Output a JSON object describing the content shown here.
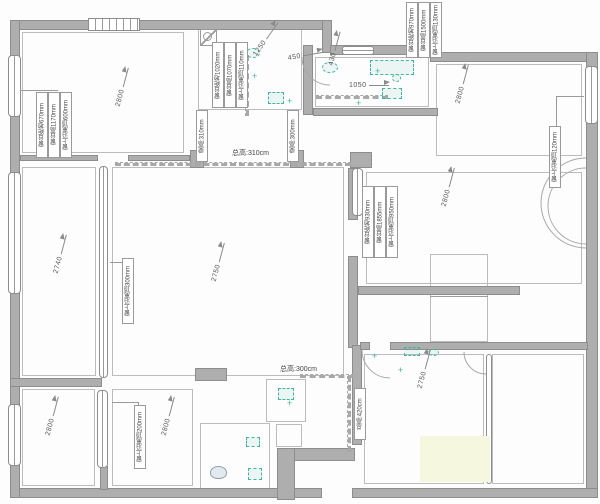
{
  "meta": {
    "app": "floor-plan-survey-drawing",
    "canvas": {
      "width": 600,
      "height": 504
    },
    "colors": {
      "wall": "#aeaeae",
      "wall_border": "#8d8d8d",
      "room_line": "#bcbcbc",
      "fixture_teal": "#45b3a2",
      "text": "#4a4a4a",
      "wash_yellow": "#f5f7df"
    }
  },
  "plan": {
    "walls": [
      {
        "x": 10,
        "y": 20,
        "w": 322,
        "h": 10
      },
      {
        "x": 322,
        "y": 20,
        "w": 10,
        "h": 33
      },
      {
        "x": 330,
        "y": 45,
        "w": 108,
        "h": 10
      },
      {
        "x": 430,
        "y": 52,
        "w": 158,
        "h": 10
      },
      {
        "x": 586,
        "y": 52,
        "w": 12,
        "h": 446
      },
      {
        "x": 352,
        "y": 488,
        "w": 246,
        "h": 10
      },
      {
        "x": 10,
        "y": 488,
        "w": 312,
        "h": 10
      },
      {
        "x": 10,
        "y": 20,
        "w": 10,
        "h": 478
      },
      {
        "x": 303,
        "y": 45,
        "w": 10,
        "h": 70
      },
      {
        "x": 313,
        "y": 108,
        "w": 125,
        "h": 8
      },
      {
        "x": 20,
        "y": 155,
        "w": 78,
        "h": 6
      },
      {
        "x": 128,
        "y": 155,
        "w": 62,
        "h": 6
      },
      {
        "x": 190,
        "y": 150,
        "w": 14,
        "h": 18
      },
      {
        "x": 290,
        "y": 150,
        "w": 14,
        "h": 18
      },
      {
        "x": 350,
        "y": 152,
        "w": 22,
        "h": 16
      },
      {
        "x": 348,
        "y": 168,
        "w": 10,
        "h": 52
      },
      {
        "x": 348,
        "y": 256,
        "w": 10,
        "h": 92
      },
      {
        "x": 358,
        "y": 286,
        "w": 162,
        "h": 9
      },
      {
        "x": 10,
        "y": 378,
        "w": 92,
        "h": 9
      },
      {
        "x": 195,
        "y": 368,
        "w": 32,
        "h": 13
      },
      {
        "x": 277,
        "y": 448,
        "w": 78,
        "h": 13
      },
      {
        "x": 277,
        "y": 448,
        "w": 18,
        "h": 52
      },
      {
        "x": 352,
        "y": 345,
        "w": 10,
        "h": 100
      },
      {
        "x": 360,
        "y": 342,
        "w": 10,
        "h": 8
      },
      {
        "x": 390,
        "y": 342,
        "w": 198,
        "h": 8
      },
      {
        "x": 100,
        "y": 466,
        "w": 8,
        "h": 24
      }
    ],
    "windows": [
      {
        "x": 8,
        "y": 55,
        "w": 13,
        "h": 62,
        "o": "v"
      },
      {
        "x": 8,
        "y": 172,
        "w": 13,
        "h": 122,
        "o": "v"
      },
      {
        "x": 8,
        "y": 404,
        "w": 13,
        "h": 62,
        "o": "v"
      },
      {
        "x": 88,
        "y": 18,
        "w": 52,
        "h": 13,
        "o": "hatch"
      },
      {
        "x": 342,
        "y": 46,
        "w": 32,
        "h": 9,
        "o": "h"
      },
      {
        "x": 585,
        "y": 66,
        "w": 13,
        "h": 58,
        "o": "v"
      },
      {
        "x": 352,
        "y": 168,
        "w": 11,
        "h": 48,
        "o": "v"
      },
      {
        "x": 99,
        "y": 166,
        "w": 9,
        "h": 212,
        "o": "v"
      },
      {
        "x": 97,
        "y": 390,
        "w": 11,
        "h": 78,
        "o": "v"
      },
      {
        "x": 486,
        "y": 354,
        "w": 6,
        "h": 130,
        "o": "v"
      }
    ],
    "rooms": [
      {
        "x": 22,
        "y": 32,
        "w": 162,
        "h": 121
      },
      {
        "x": 198,
        "y": 28,
        "w": 104,
        "h": 82
      },
      {
        "x": 315,
        "y": 57,
        "w": 114,
        "h": 50
      },
      {
        "x": 436,
        "y": 64,
        "w": 146,
        "h": 92
      },
      {
        "x": 22,
        "y": 167,
        "w": 74,
        "h": 209
      },
      {
        "x": 112,
        "y": 167,
        "w": 232,
        "h": 209
      },
      {
        "x": 366,
        "y": 172,
        "w": 216,
        "h": 112
      },
      {
        "x": 430,
        "y": 254,
        "w": 58,
        "h": 88
      },
      {
        "x": 22,
        "y": 389,
        "w": 73,
        "h": 97
      },
      {
        "x": 112,
        "y": 389,
        "w": 81,
        "h": 97
      },
      {
        "x": 200,
        "y": 423,
        "w": 70,
        "h": 68
      },
      {
        "x": 266,
        "y": 379,
        "w": 40,
        "h": 43
      },
      {
        "x": 276,
        "y": 424,
        "w": 26,
        "h": 23
      },
      {
        "x": 364,
        "y": 354,
        "w": 120,
        "h": 130
      },
      {
        "x": 492,
        "y": 354,
        "w": 92,
        "h": 130
      }
    ],
    "lines": [
      {
        "x": 20,
        "y": 90,
        "w": 38,
        "h": 0,
        "dash": 0
      },
      {
        "x": 556,
        "y": 96,
        "w": 28,
        "h": 0,
        "dash": 0
      },
      {
        "x": 556,
        "y": 96,
        "w": 0,
        "h": 30,
        "dash": 0
      },
      {
        "x": 110,
        "y": 262,
        "w": 14,
        "h": 0,
        "dash": 0
      },
      {
        "x": 112,
        "y": 402,
        "w": 26,
        "h": 0,
        "dash": 0
      },
      {
        "x": 138,
        "y": 402,
        "w": 0,
        "h": 6,
        "dash": 0
      },
      {
        "x": 115,
        "y": 162,
        "w": 230,
        "h": 0,
        "dash": 1
      },
      {
        "x": 300,
        "y": 374,
        "w": 48,
        "h": 0,
        "dash": 1
      },
      {
        "x": 347,
        "y": 376,
        "w": 0,
        "h": 70,
        "dash": 1
      },
      {
        "x": 430,
        "y": 296,
        "w": 58,
        "h": 0,
        "dash": 0
      },
      {
        "x": 316,
        "y": 95,
        "w": 66,
        "h": 0,
        "dash": 1
      },
      {
        "x": 245,
        "y": 55,
        "w": 0,
        "h": 55,
        "dash": 1
      }
    ],
    "arcs": [
      {
        "d": "M 302,57 A 28,28 0 0 0 330,85"
      },
      {
        "d": "M 362,350 A 28,28 0 0 0 390,378"
      },
      {
        "d": "M 464,352 A 22,22 0 0 0 486,374"
      },
      {
        "d": "M 586,158 A 45,45 0 0 0 586,248"
      },
      {
        "d": "M 586,168 A 38,38 0 0 0 586,244"
      }
    ],
    "fixtures": [
      {
        "t": "shower",
        "x": 200,
        "y": 29,
        "w": 17,
        "h": 17
      },
      {
        "t": "ell",
        "x": 246,
        "y": 48,
        "w": 14,
        "h": 10
      },
      {
        "t": "rect",
        "x": 268,
        "y": 92,
        "w": 16,
        "h": 12
      },
      {
        "t": "cross",
        "x": 252,
        "y": 72
      },
      {
        "t": "cross",
        "x": 287,
        "y": 97
      },
      {
        "t": "ell",
        "x": 322,
        "y": 62,
        "w": 16,
        "h": 11
      },
      {
        "t": "rect",
        "x": 370,
        "y": 60,
        "w": 44,
        "h": 15
      },
      {
        "t": "rect",
        "x": 382,
        "y": 88,
        "w": 20,
        "h": 11
      },
      {
        "t": "cross",
        "x": 356,
        "y": 99
      },
      {
        "t": "cross",
        "x": 375,
        "y": 67
      },
      {
        "t": "ell",
        "x": 392,
        "y": 74,
        "w": 9,
        "h": 8
      },
      {
        "t": "rect",
        "x": 404,
        "y": 347,
        "w": 16,
        "h": 9
      },
      {
        "t": "ell",
        "x": 428,
        "y": 349,
        "w": 11,
        "h": 7
      },
      {
        "t": "cross",
        "x": 372,
        "y": 352
      },
      {
        "t": "cross",
        "x": 398,
        "y": 366
      },
      {
        "t": "wash",
        "x": 420,
        "y": 436,
        "w": 70,
        "h": 46
      },
      {
        "t": "toilet",
        "x": 210,
        "y": 466,
        "w": 17,
        "h": 13
      },
      {
        "t": "rect",
        "x": 246,
        "y": 437,
        "w": 14,
        "h": 10
      },
      {
        "t": "rect",
        "x": 248,
        "y": 468,
        "w": 14,
        "h": 12
      },
      {
        "t": "rect",
        "x": 278,
        "y": 388,
        "w": 16,
        "h": 12
      },
      {
        "t": "cross",
        "x": 287,
        "y": 399
      }
    ],
    "dims": [
      {
        "text": "2800",
        "x": 118,
        "y": 103,
        "rot": -75
      },
      {
        "text": "1250",
        "x": 255,
        "y": 52,
        "rot": -55
      },
      {
        "text": "450",
        "x": 288,
        "y": 55,
        "rot": -10
      },
      {
        "text": "430",
        "x": 331,
        "y": 62,
        "rot": -75
      },
      {
        "text": "1050",
        "x": 349,
        "y": 82,
        "rot": 0
      },
      {
        "text": "2800",
        "x": 458,
        "y": 100,
        "rot": -75
      },
      {
        "text": "2800",
        "x": 444,
        "y": 203,
        "rot": -75
      },
      {
        "text": "2740",
        "x": 56,
        "y": 270,
        "rot": -75
      },
      {
        "text": "2750",
        "x": 214,
        "y": 278,
        "rot": -75
      },
      {
        "text": "2800",
        "x": 48,
        "y": 432,
        "rot": -75
      },
      {
        "text": "2800",
        "x": 164,
        "y": 432,
        "rot": -75
      },
      {
        "text": "2750",
        "x": 420,
        "y": 385,
        "rot": -75
      }
    ],
    "note_groups": [
      {
        "x": 36,
        "y": 92,
        "h": 66,
        "items": [
          "窗台距地670mm",
          "窗台高1170mm",
          "窗上沿离顶600mm"
        ]
      },
      {
        "x": 212,
        "y": 42,
        "h": 66,
        "items": [
          "窗台距地1020mm",
          "窗台高1070mm",
          "窗上沿离顶110mm"
        ]
      },
      {
        "x": 406,
        "y": 2,
        "h": 56,
        "items": [
          "窗台距地970mm",
          "窗台高1500mm",
          "窗上沿离顶130mm"
        ]
      },
      {
        "x": 362,
        "y": 186,
        "h": 72,
        "items": [
          "窗台距地930mm",
          "窗台高1855mm",
          "窗上沿离顶950mm"
        ]
      },
      {
        "x": 549,
        "y": 126,
        "h": 62,
        "items": [
          "窗上沿离顶120mm"
        ]
      },
      {
        "x": 122,
        "y": 258,
        "h": 66,
        "items": [
          "窗上沿离顶300mm"
        ]
      },
      {
        "x": 134,
        "y": 405,
        "h": 64,
        "items": [
          "窗上沿离顶200mm"
        ]
      },
      {
        "x": 354,
        "y": 388,
        "h": 52,
        "items": [
          "总高:420cm"
        ]
      },
      {
        "x": 196,
        "y": 110,
        "h": 52,
        "items": [
          "梁高:310mm"
        ]
      },
      {
        "x": 287,
        "y": 110,
        "h": 52,
        "items": [
          "梁高:300mm"
        ]
      }
    ],
    "height_notes": [
      {
        "text": "总高:310cm",
        "x": 232,
        "y": 148
      },
      {
        "text": "总高:300cm",
        "x": 280,
        "y": 364
      }
    ]
  }
}
